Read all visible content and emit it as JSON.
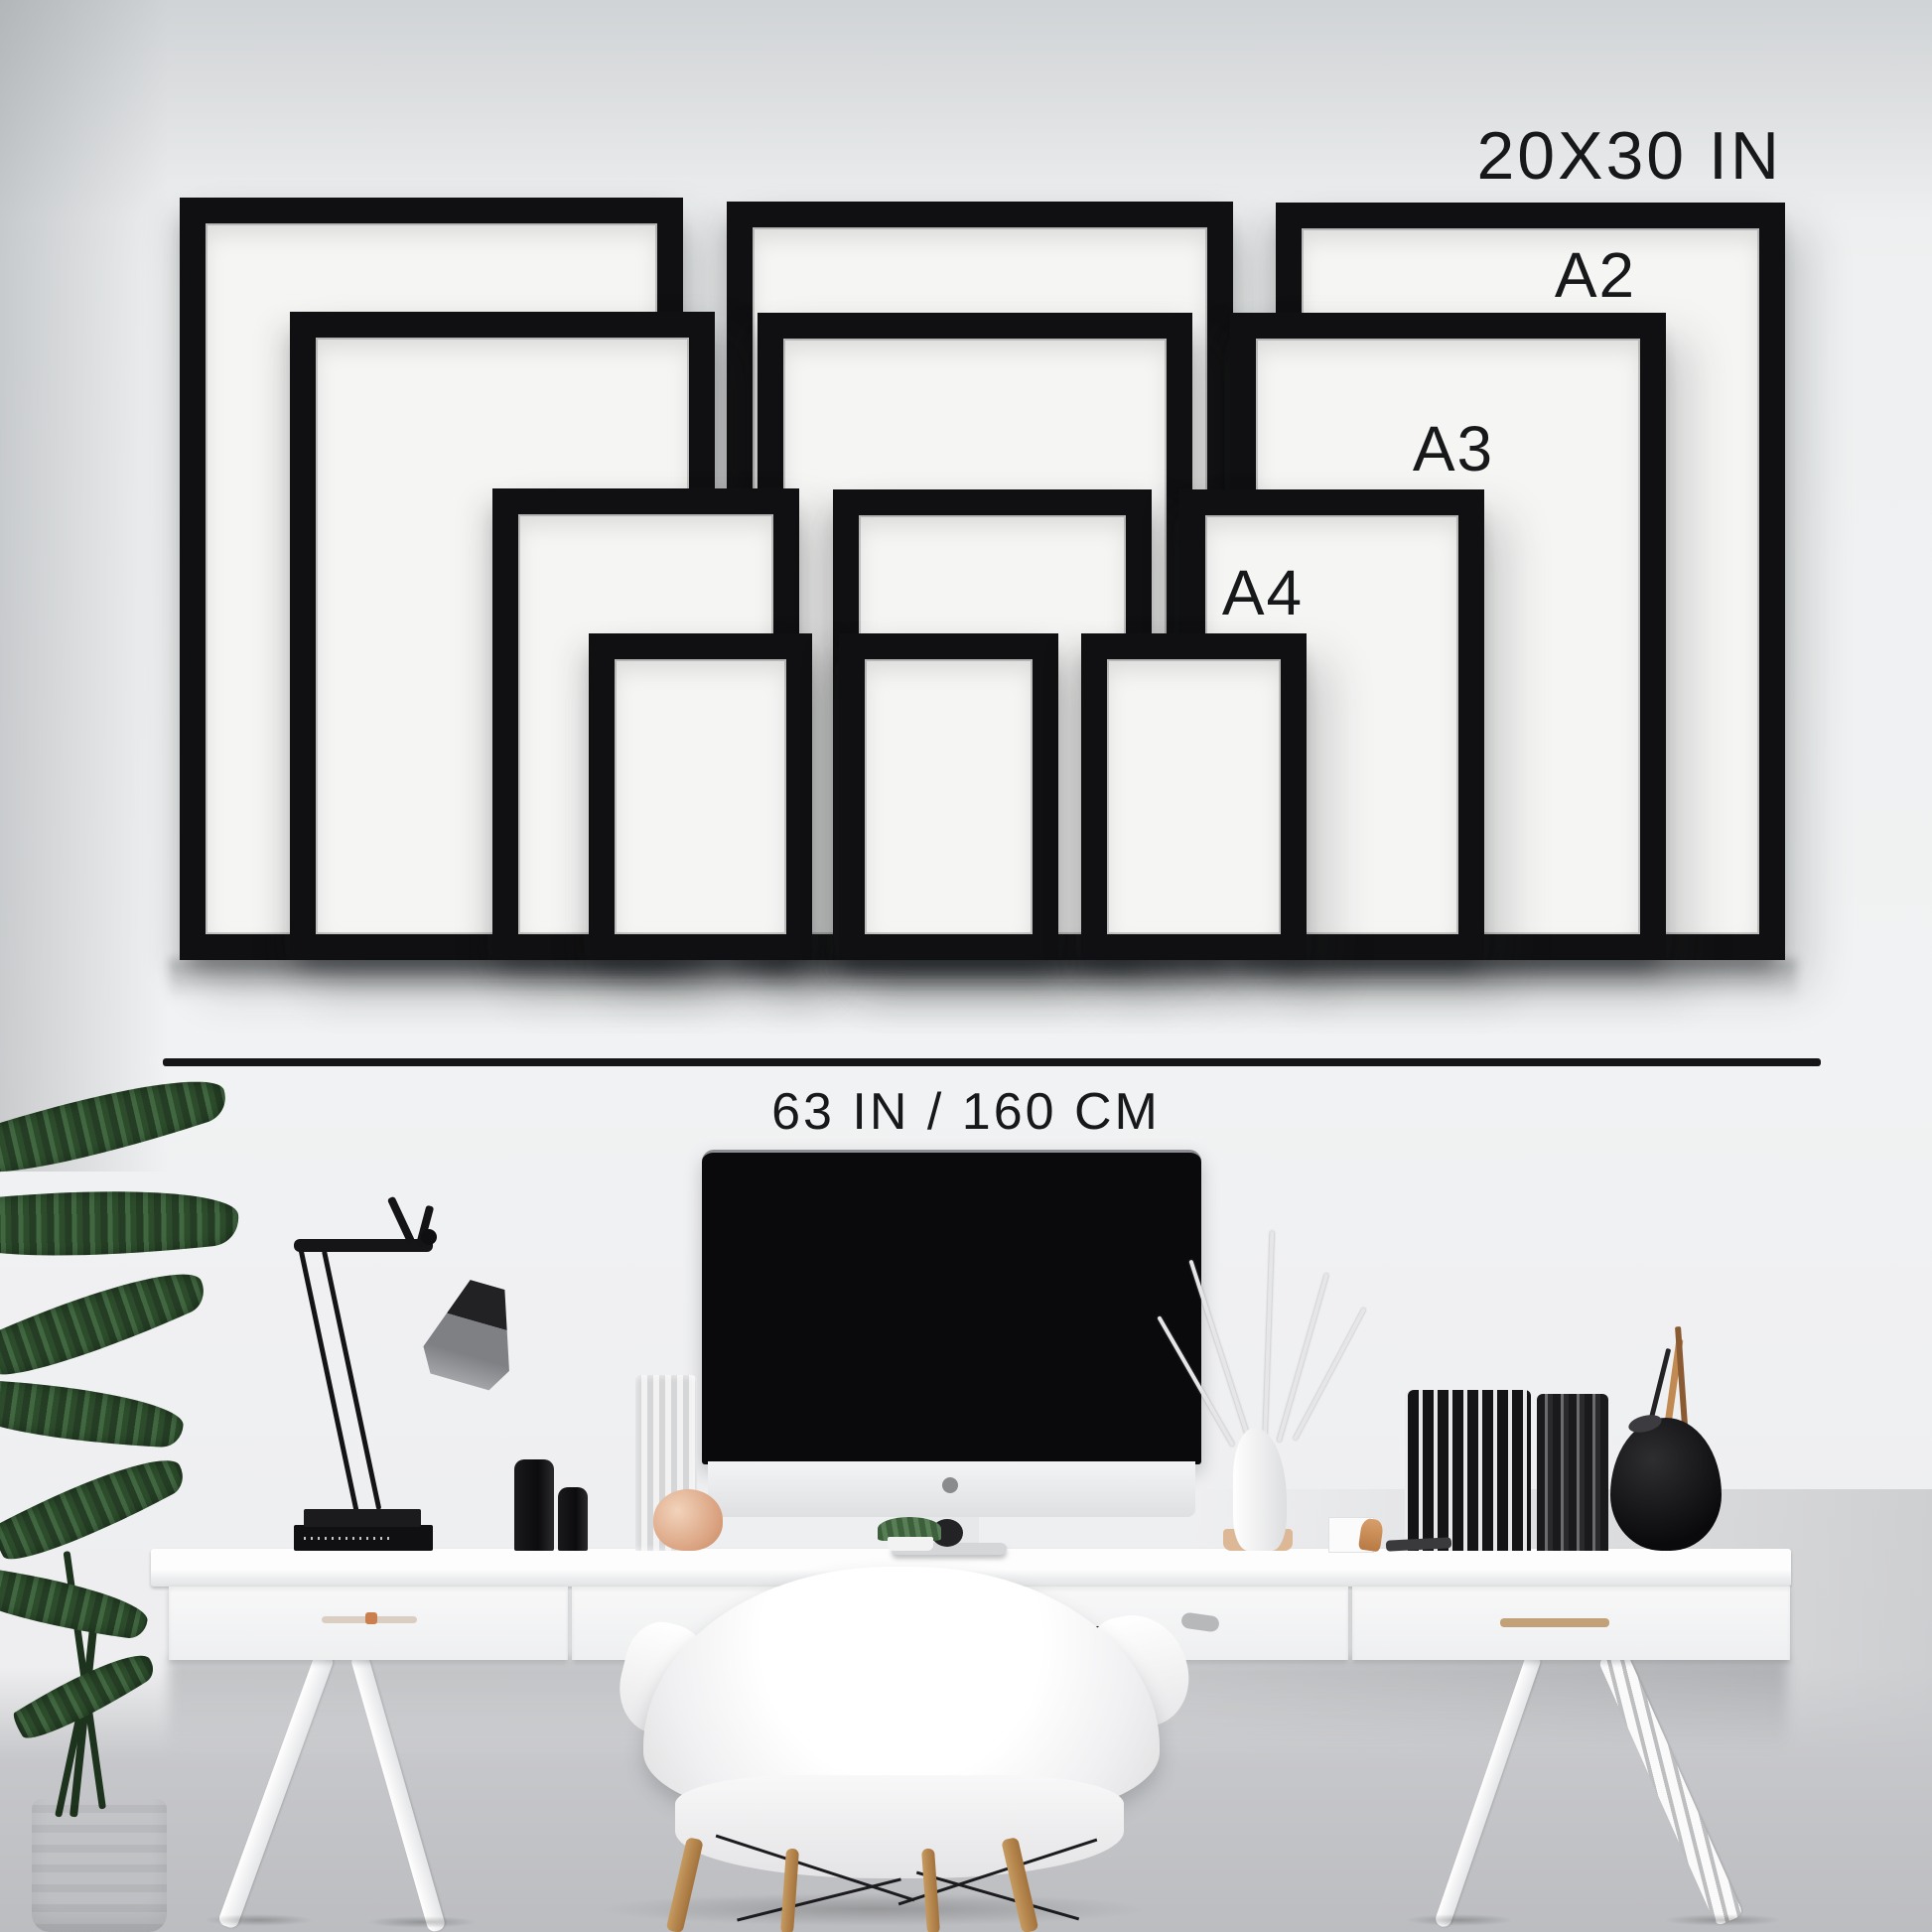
{
  "size_guide": {
    "labels": {
      "largest_size": "20X30 IN",
      "size_a2": "A2",
      "size_a3": "A3",
      "size_a4": "A4",
      "total_width": "63 IN / 160 CM"
    },
    "frames": [
      {
        "size": "20X30 IN",
        "column": "left"
      },
      {
        "size": "20X30 IN",
        "column": "center"
      },
      {
        "size": "20X30 IN",
        "column": "right"
      },
      {
        "size": "A2",
        "column": "left"
      },
      {
        "size": "A2",
        "column": "center"
      },
      {
        "size": "A2",
        "column": "right"
      },
      {
        "size": "A3",
        "column": "left"
      },
      {
        "size": "A3",
        "column": "center"
      },
      {
        "size": "A3",
        "column": "right"
      },
      {
        "size": "A4",
        "column": "left"
      },
      {
        "size": "A4",
        "column": "center"
      },
      {
        "size": "A4",
        "column": "right"
      }
    ]
  },
  "colors": {
    "wall": "#eef0f1",
    "frame": "#101012",
    "frame_mat": "#f5f5f4",
    "text": "#17181a",
    "divider_line": "#151517",
    "desk": "#fafafa",
    "floor": "#c6c7ca",
    "monitor_screen": "#0a0a0c",
    "wood": "#b9894f",
    "plant_green": "#3a5c3a",
    "copper": "#c98f5f"
  },
  "scene": {
    "objects": [
      "frame-wall-gallery",
      "desk-lamp",
      "computer-monitor",
      "white-desk",
      "shell-armchair",
      "potted-plant",
      "glass-vase",
      "black-bottles",
      "dried-branches-vase",
      "standing-books",
      "black-vase-with-pencils",
      "copper-figurine"
    ]
  }
}
